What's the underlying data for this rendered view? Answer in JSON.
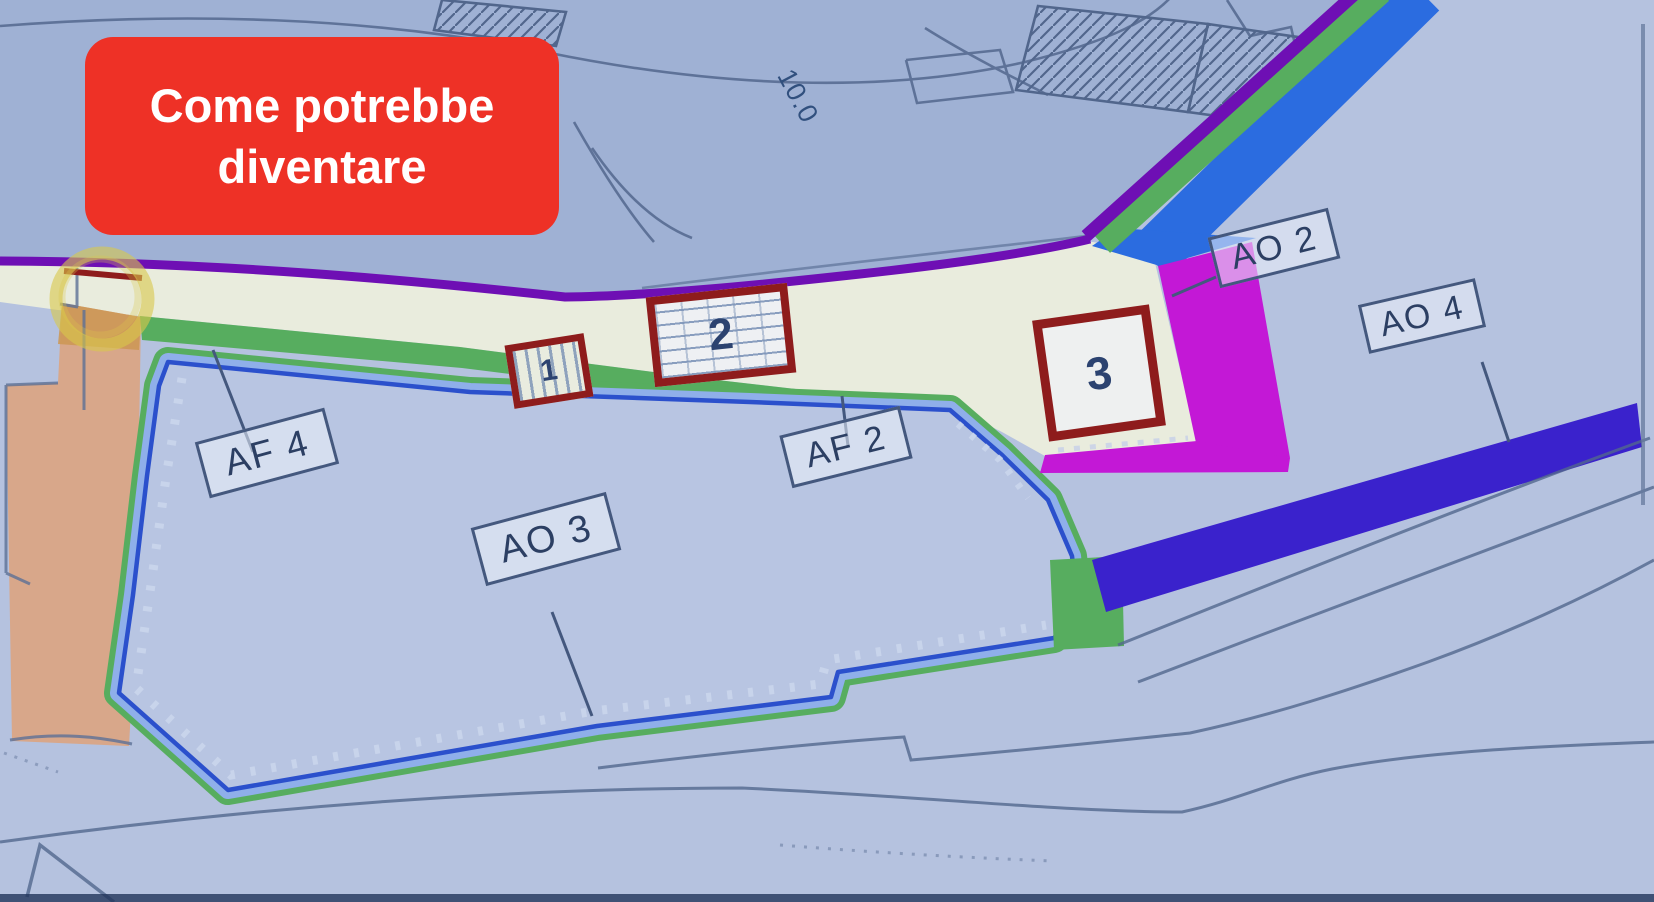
{
  "annotation": {
    "label": "Come potrebbe diventare",
    "background_color": "#ee3126",
    "text_color": "#ffffff"
  },
  "map": {
    "measurement_label": "10.0",
    "buildings": [
      {
        "number": "1"
      },
      {
        "number": "2"
      },
      {
        "number": "3"
      }
    ],
    "zones": [
      {
        "code": "AF 4"
      },
      {
        "code": "AO 3"
      },
      {
        "code": "AF 2"
      },
      {
        "code": "AO 2"
      },
      {
        "code": "AO 4"
      }
    ],
    "colors": {
      "road_fill_cream": "#e9ecdd",
      "band_green": "#57ad5f",
      "ribbon_blue": "#2b6ce0",
      "parcel_band_blue": "#8fafea",
      "parcel_line_blue": "#2b50cc",
      "zone_magenta": "#c318d6",
      "zone_indigo": "#3a22cc",
      "zone_tan": "#d8a78a",
      "line_purple": "#6e0fb4",
      "building_outline_red": "#8e1c1c",
      "highlight_yellow": "#d9c84b"
    }
  }
}
